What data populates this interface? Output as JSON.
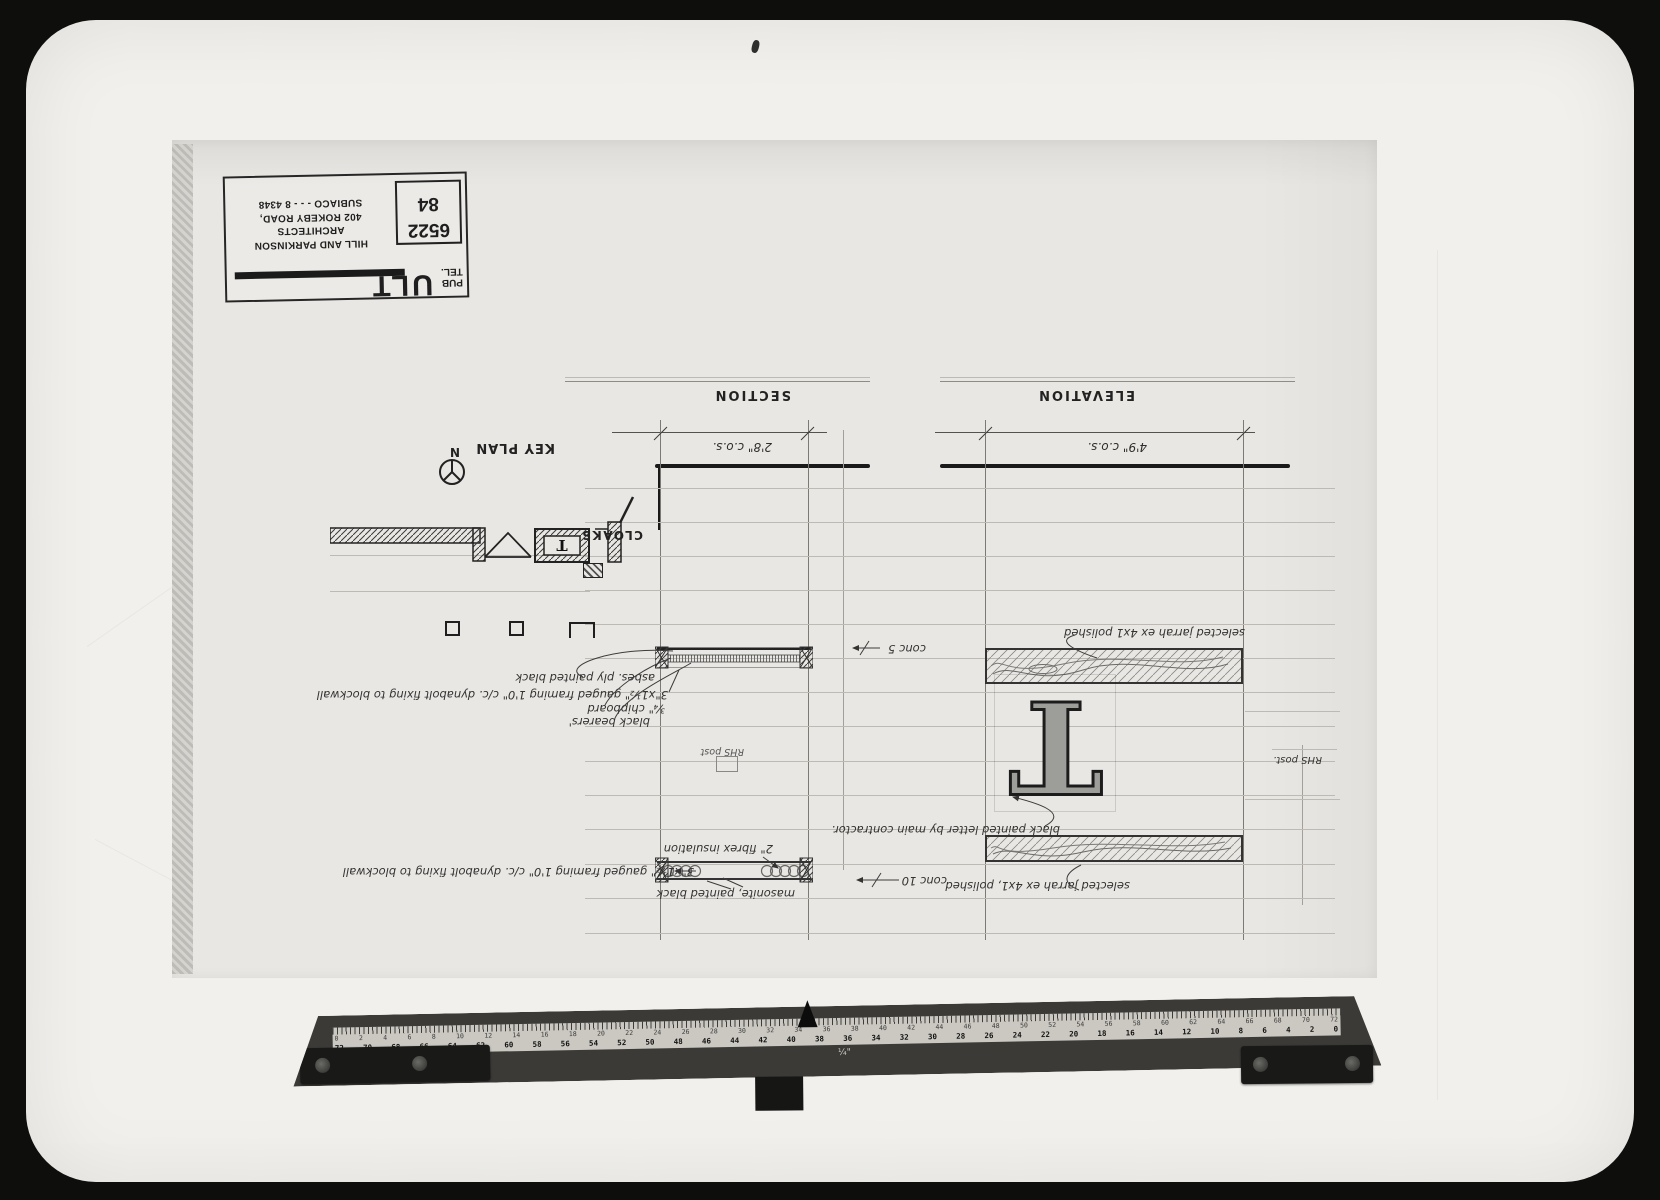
{
  "colors": {
    "photo_bg": "#0e0e0d",
    "table": "#f1f0ed",
    "sheet": "#e9e7e3",
    "ink": "#1a1a1a",
    "ruler_body": "#3b3a37",
    "ruler_strip": "#cac8c1"
  },
  "stamp": {
    "big_text": "ULT",
    "small_top": "PUB",
    "small_bottom": "TEL.",
    "firm_line1": "HILL AND PARKINSON",
    "firm_line2": "ARCHITECTS",
    "firm_line3": "402 ROKEBY ROAD,",
    "firm_line4": "SUBIACO - - - 8 4348",
    "job_number": "6522",
    "job_year": "84"
  },
  "titles": {
    "section": "SECTION",
    "elevation": "ELEVATION"
  },
  "dimensions": {
    "section": "2'8\" c.o.s.",
    "elevation": "4'9\" c.o.s."
  },
  "key_plan": {
    "label": "KEY PLAN",
    "north_letter": "N",
    "room_label": "CLOAKS",
    "letter_in_plan": "T"
  },
  "section_notes": {
    "ply": "asbes. ply painted black",
    "bearers": "black bearers'",
    "chipboard": "¾\" chipboard",
    "framing_upper": "3\"x1½\" gauged framing 1'0\" c/c. dynabolt fixing to blockwall",
    "conc_upper": "conc 5",
    "post_label": "RHS post",
    "insulation": "2\" fibrex insulation",
    "framing_lower": "3\"x1½\" gauged framing 1'0\" c/c. dynabolt fixing to blockwall",
    "masonite": "masonite, painted black",
    "conc_lower": "conc 10"
  },
  "elevation_notes": {
    "jarrah_top": "selected jarrah ex 4x1 polished",
    "letter": "T",
    "letter_note": "black painted letter by main contractor.",
    "post_label": "RHS post.",
    "jarrah_bottom": "selected jarrah ex 4x1, polished"
  },
  "ruler": {
    "top_numbers": [
      0,
      2,
      4,
      6,
      8,
      10,
      12,
      14,
      16,
      18,
      20,
      22,
      24,
      26,
      28,
      30,
      32,
      34,
      36,
      38,
      40,
      42,
      44,
      46,
      48,
      50,
      52,
      54,
      56,
      58,
      60,
      62,
      64,
      66,
      68,
      70,
      72
    ],
    "bottom_numbers": [
      72,
      70,
      68,
      66,
      64,
      62,
      60,
      58,
      56,
      54,
      52,
      50,
      48,
      46,
      44,
      42,
      40,
      38,
      36,
      34,
      32,
      30,
      28,
      26,
      24,
      22,
      20,
      18,
      16,
      14,
      12,
      10,
      8,
      6,
      4,
      2,
      0
    ],
    "scale_label": "¼\""
  }
}
